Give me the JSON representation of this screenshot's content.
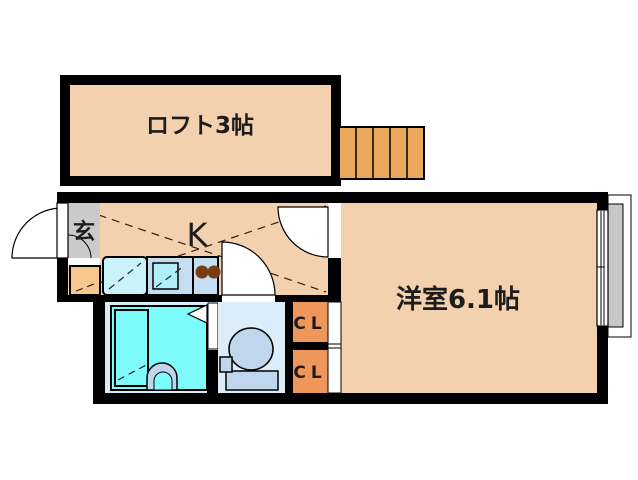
{
  "floorplan": {
    "title": "1K apartment floor plan with loft",
    "rooms": {
      "loft": {
        "label": "ロフト3帖",
        "color": "#f3d1ae"
      },
      "kitchen": {
        "label": "K",
        "color": "#f3d1ae"
      },
      "entrance": {
        "label": "玄",
        "color": "#cacaca"
      },
      "western_room": {
        "label": "洋室6.1帖",
        "color": "#f3d1ae"
      },
      "closet_upper": {
        "label": "CL",
        "color": "#ef965b"
      },
      "closet_lower": {
        "label": "CL",
        "color": "#ef965b"
      },
      "bathroom": {
        "color": "#7efbfb"
      },
      "toilet_room": {
        "color": "#ddecf9"
      }
    },
    "colors": {
      "wall": "#000000",
      "stairs": "#e9a85b",
      "entrance_step": "#f8c78f",
      "kitchen_counter": "#c4ddf2",
      "kitchen_sink": "#b0eff8",
      "washer_pan": "#c9f2fb",
      "stove_burner": "#7a3b12",
      "fixture_blue": "#bfd6ed",
      "bathroom_floor": "#daebf8",
      "balcony": "#c6c6c6"
    },
    "fixtures": [
      "stairs",
      "entrance-door",
      "entrance-step",
      "washing-machine-pan",
      "kitchen-sink",
      "gas-stove",
      "bathtub",
      "shower-faucet",
      "folding-bath-door",
      "toilet",
      "sliding-closet-door",
      "sliding-window",
      "balcony"
    ]
  }
}
